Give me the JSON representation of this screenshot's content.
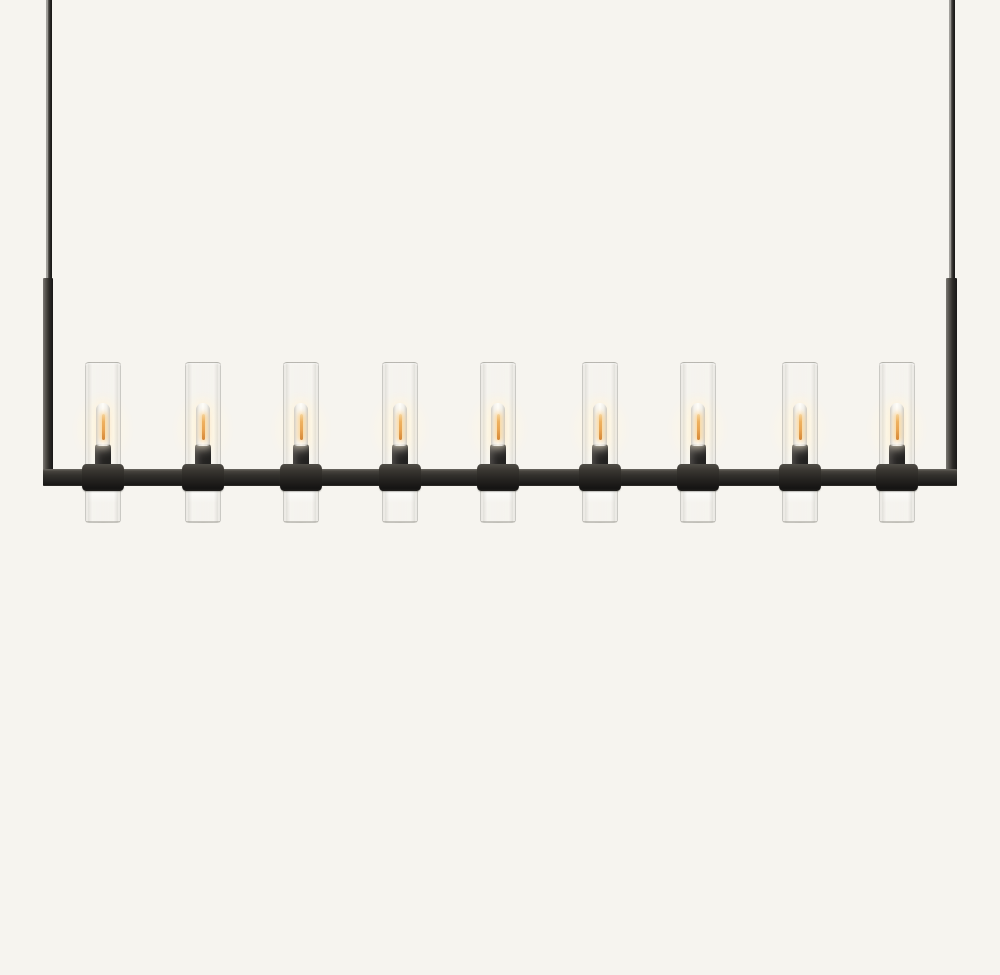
{
  "scene": {
    "type": "product-photo",
    "subject": "Linear chandelier with nine clear glass cylinder shades, lit tubular filament bulbs and a blackened metal rectangular frame suspended by two thin rods"
  },
  "colors": {
    "background": "#f6f4ef",
    "metal-dark": "#1c1b19",
    "metal-mid": "#35322e",
    "metal-highlight": "#8c8a85",
    "glass-edge": "#9b9893",
    "filament-amber": "#e9a14b",
    "filament-bright": "#f6d398",
    "glow-warm": "#fff4dd"
  },
  "chandelier": {
    "light_count": 9,
    "lights_centers_x": [
      103,
      203,
      301,
      400,
      498,
      600,
      698,
      800,
      897
    ],
    "unit_half_width": 21,
    "bulbs_lit": true
  }
}
